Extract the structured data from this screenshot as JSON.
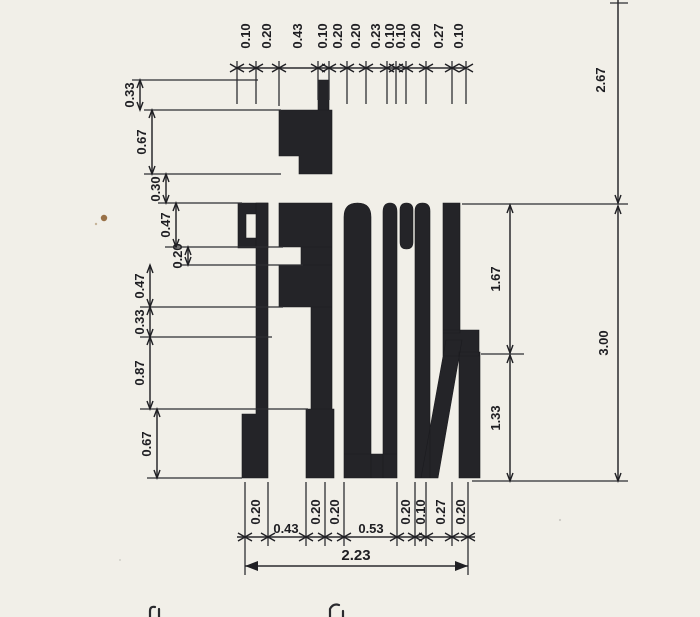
{
  "paper": {
    "background": "#f1efe8",
    "ink": "#242428",
    "line_color": "#2a2a2e",
    "fleck_color": "#8a5a2a"
  },
  "lettering": {
    "word": "เรียน",
    "letters": [
      "เ",
      "ร",
      "ี",
      "ย",
      "น"
    ]
  },
  "dimensions": {
    "top": [
      "0.10",
      "0.20",
      "0.43",
      "0.10",
      "0.20",
      "0.20",
      "0.23",
      "0.10",
      "0.10",
      "0.20",
      "0.27",
      "0.10"
    ],
    "left": [
      "0.33",
      "0.67",
      "0.30",
      "0.47",
      "0.20",
      "0.47",
      "0.33",
      "0.87",
      "0.67"
    ],
    "right": [
      "2.67",
      "1.67",
      "1.33",
      "3.00"
    ],
    "bottom": [
      "0.20",
      "0.43",
      "0.20",
      "0.20",
      "0.53",
      "0.20",
      "0.10",
      "0.27",
      "0.20"
    ],
    "bottom_total": "2.23"
  }
}
